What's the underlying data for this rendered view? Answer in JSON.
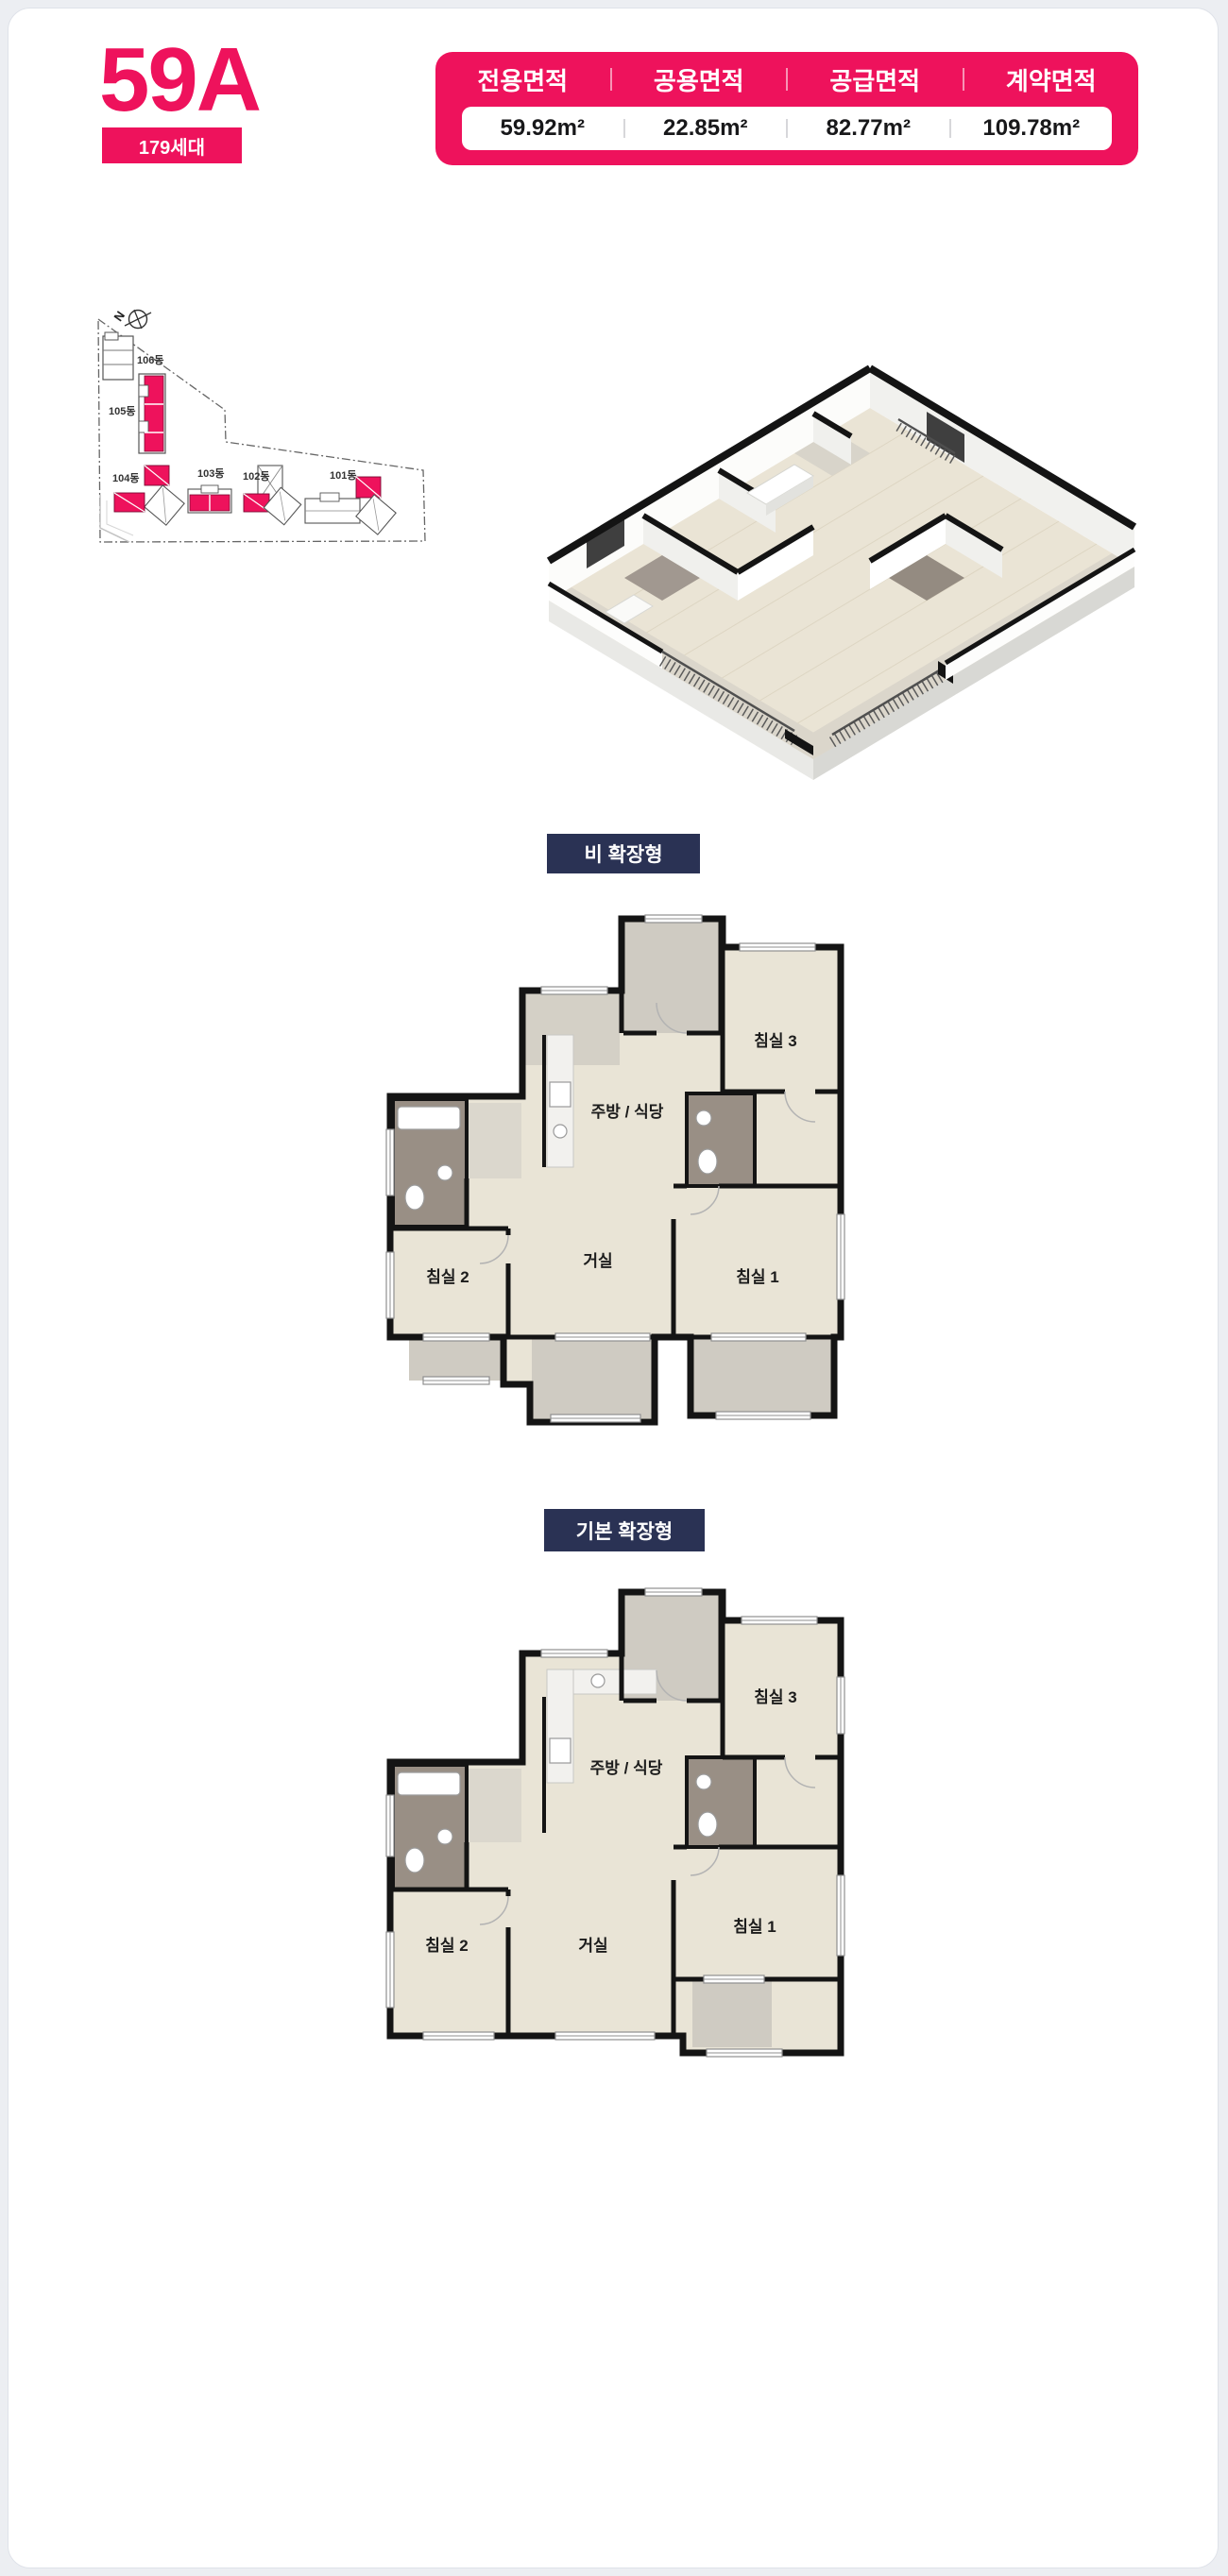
{
  "colors": {
    "accent_pink": "#EE125C",
    "label_navy": "#2A3254"
  },
  "header": {
    "unit_type": "59A",
    "household_badge": "179세대",
    "area_table": {
      "columns": [
        {
          "label": "전용면적",
          "value": "59.92m²"
        },
        {
          "label": "공용면적",
          "value": "22.85m²"
        },
        {
          "label": "공급면적",
          "value": "82.77m²"
        },
        {
          "label": "계약면적",
          "value": "109.78m²"
        }
      ]
    }
  },
  "site_plan": {
    "north_label": "N",
    "buildings": [
      {
        "name": "106동"
      },
      {
        "name": "105동"
      },
      {
        "name": "104동"
      },
      {
        "name": "103동"
      },
      {
        "name": "102동"
      },
      {
        "name": "101동"
      }
    ]
  },
  "plans": [
    {
      "variant_label": "비 확장형",
      "rooms": {
        "bedroom3": "침실 3",
        "kitchen_dining": "주방 / 식당",
        "bedroom2": "침실 2",
        "living": "거실",
        "bedroom1": "침실 1"
      }
    },
    {
      "variant_label": "기본 확장형",
      "rooms": {
        "bedroom3": "침실 3",
        "kitchen_dining": "주방 / 식당",
        "bedroom2": "침실 2",
        "living": "거실",
        "bedroom1": "침실 1"
      }
    }
  ]
}
